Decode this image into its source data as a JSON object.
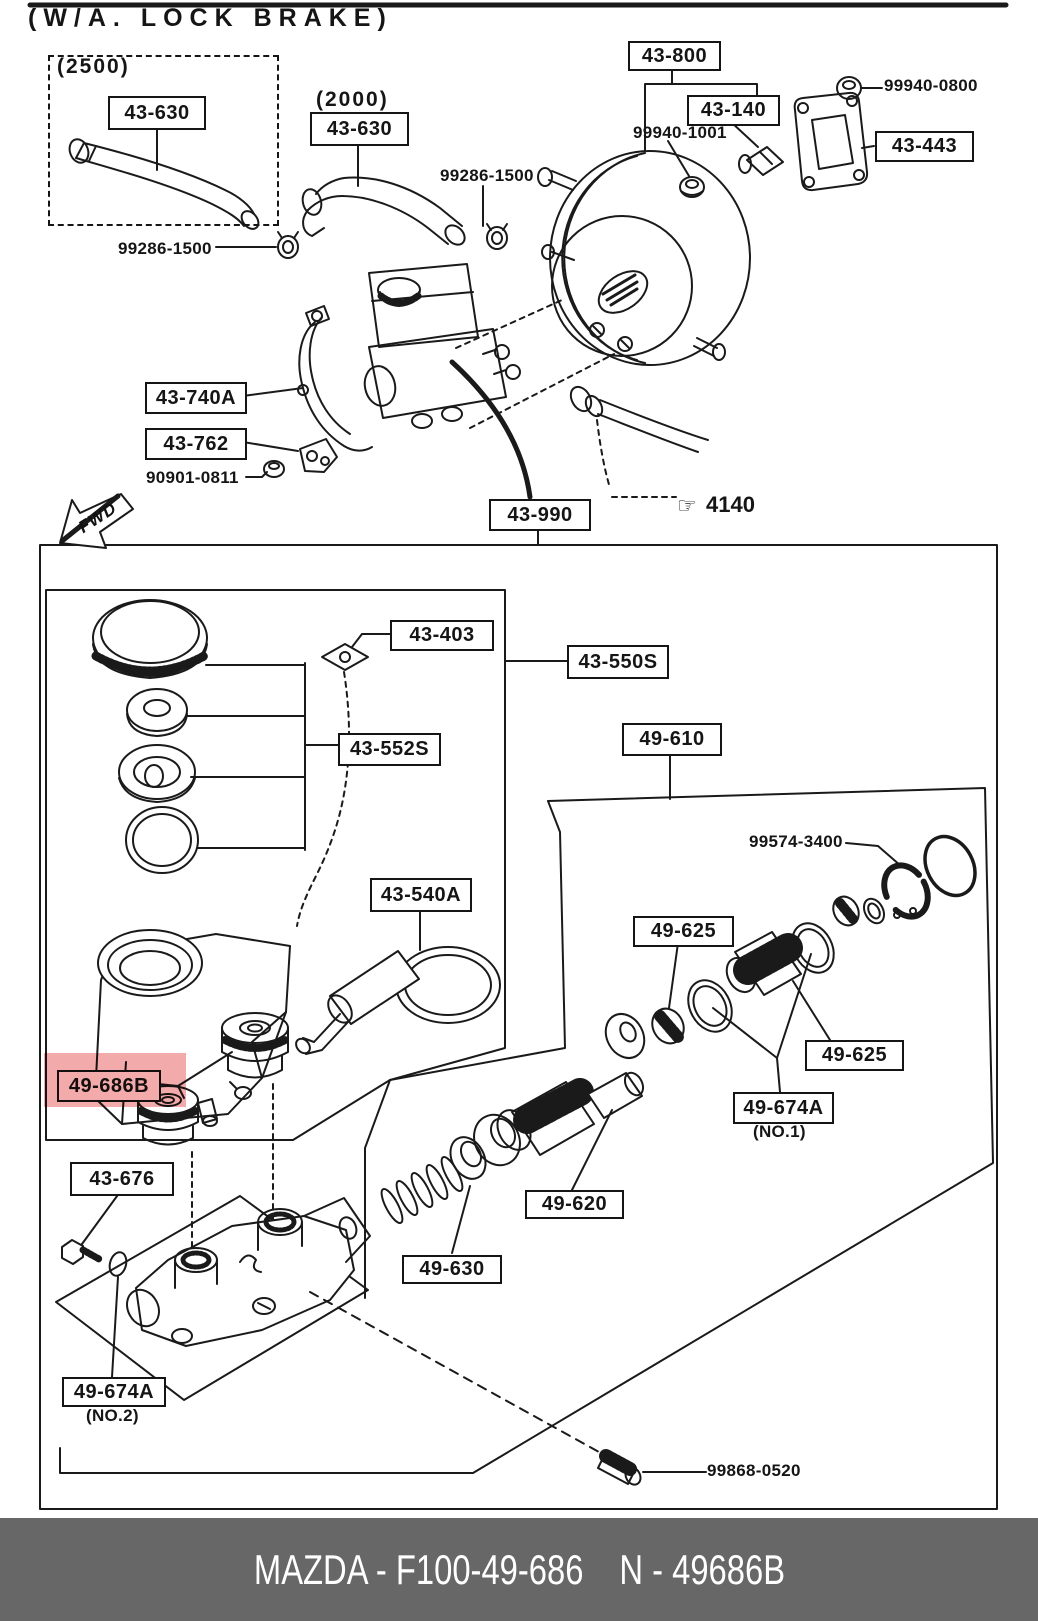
{
  "title": "(W/A. LOCK BRAKE)",
  "variants": {
    "v2500": "(2500)",
    "v2000": "(2000)"
  },
  "labels": {
    "l43630a": "43-630",
    "l43630b": "43-630",
    "l43800": "43-800",
    "l43140": "43-140",
    "l43443": "43-443",
    "l99940_0800": "99940-0800",
    "l99940_1001": "99940-1001",
    "l99286_1500r": "99286-1500",
    "l99286_1500l": "99286-1500",
    "l43740a": "43-740A",
    "l43762": "43-762",
    "l90901_0811": "90901-0811",
    "l43990": "43-990",
    "l4140": "4140",
    "l43403": "43-403",
    "l43550s": "43-550S",
    "l43552s": "43-552S",
    "l49610": "49-610",
    "l99574_3400": "99574-3400",
    "l43540a": "43-540A",
    "l49625a": "49-625",
    "l49625b": "49-625",
    "l49674a1": "49-674A",
    "no1": "(NO.1)",
    "l49686b": "49-686B",
    "l43676": "43-676",
    "l49620": "49-620",
    "l49630": "49-630",
    "l49674a2": "49-674A",
    "no2": "(NO.2)",
    "l99868_0520": "99868-0520"
  },
  "icons": {
    "fwd_arrow": "FWD",
    "pointing_hand": "☞"
  },
  "colors": {
    "ink": "#1a1a1a",
    "highlight": "#ee8e8e",
    "footer_bg": "#676767"
  },
  "footer": {
    "left": "MAZDA - F100-49-686",
    "right": "N - 49686B"
  }
}
